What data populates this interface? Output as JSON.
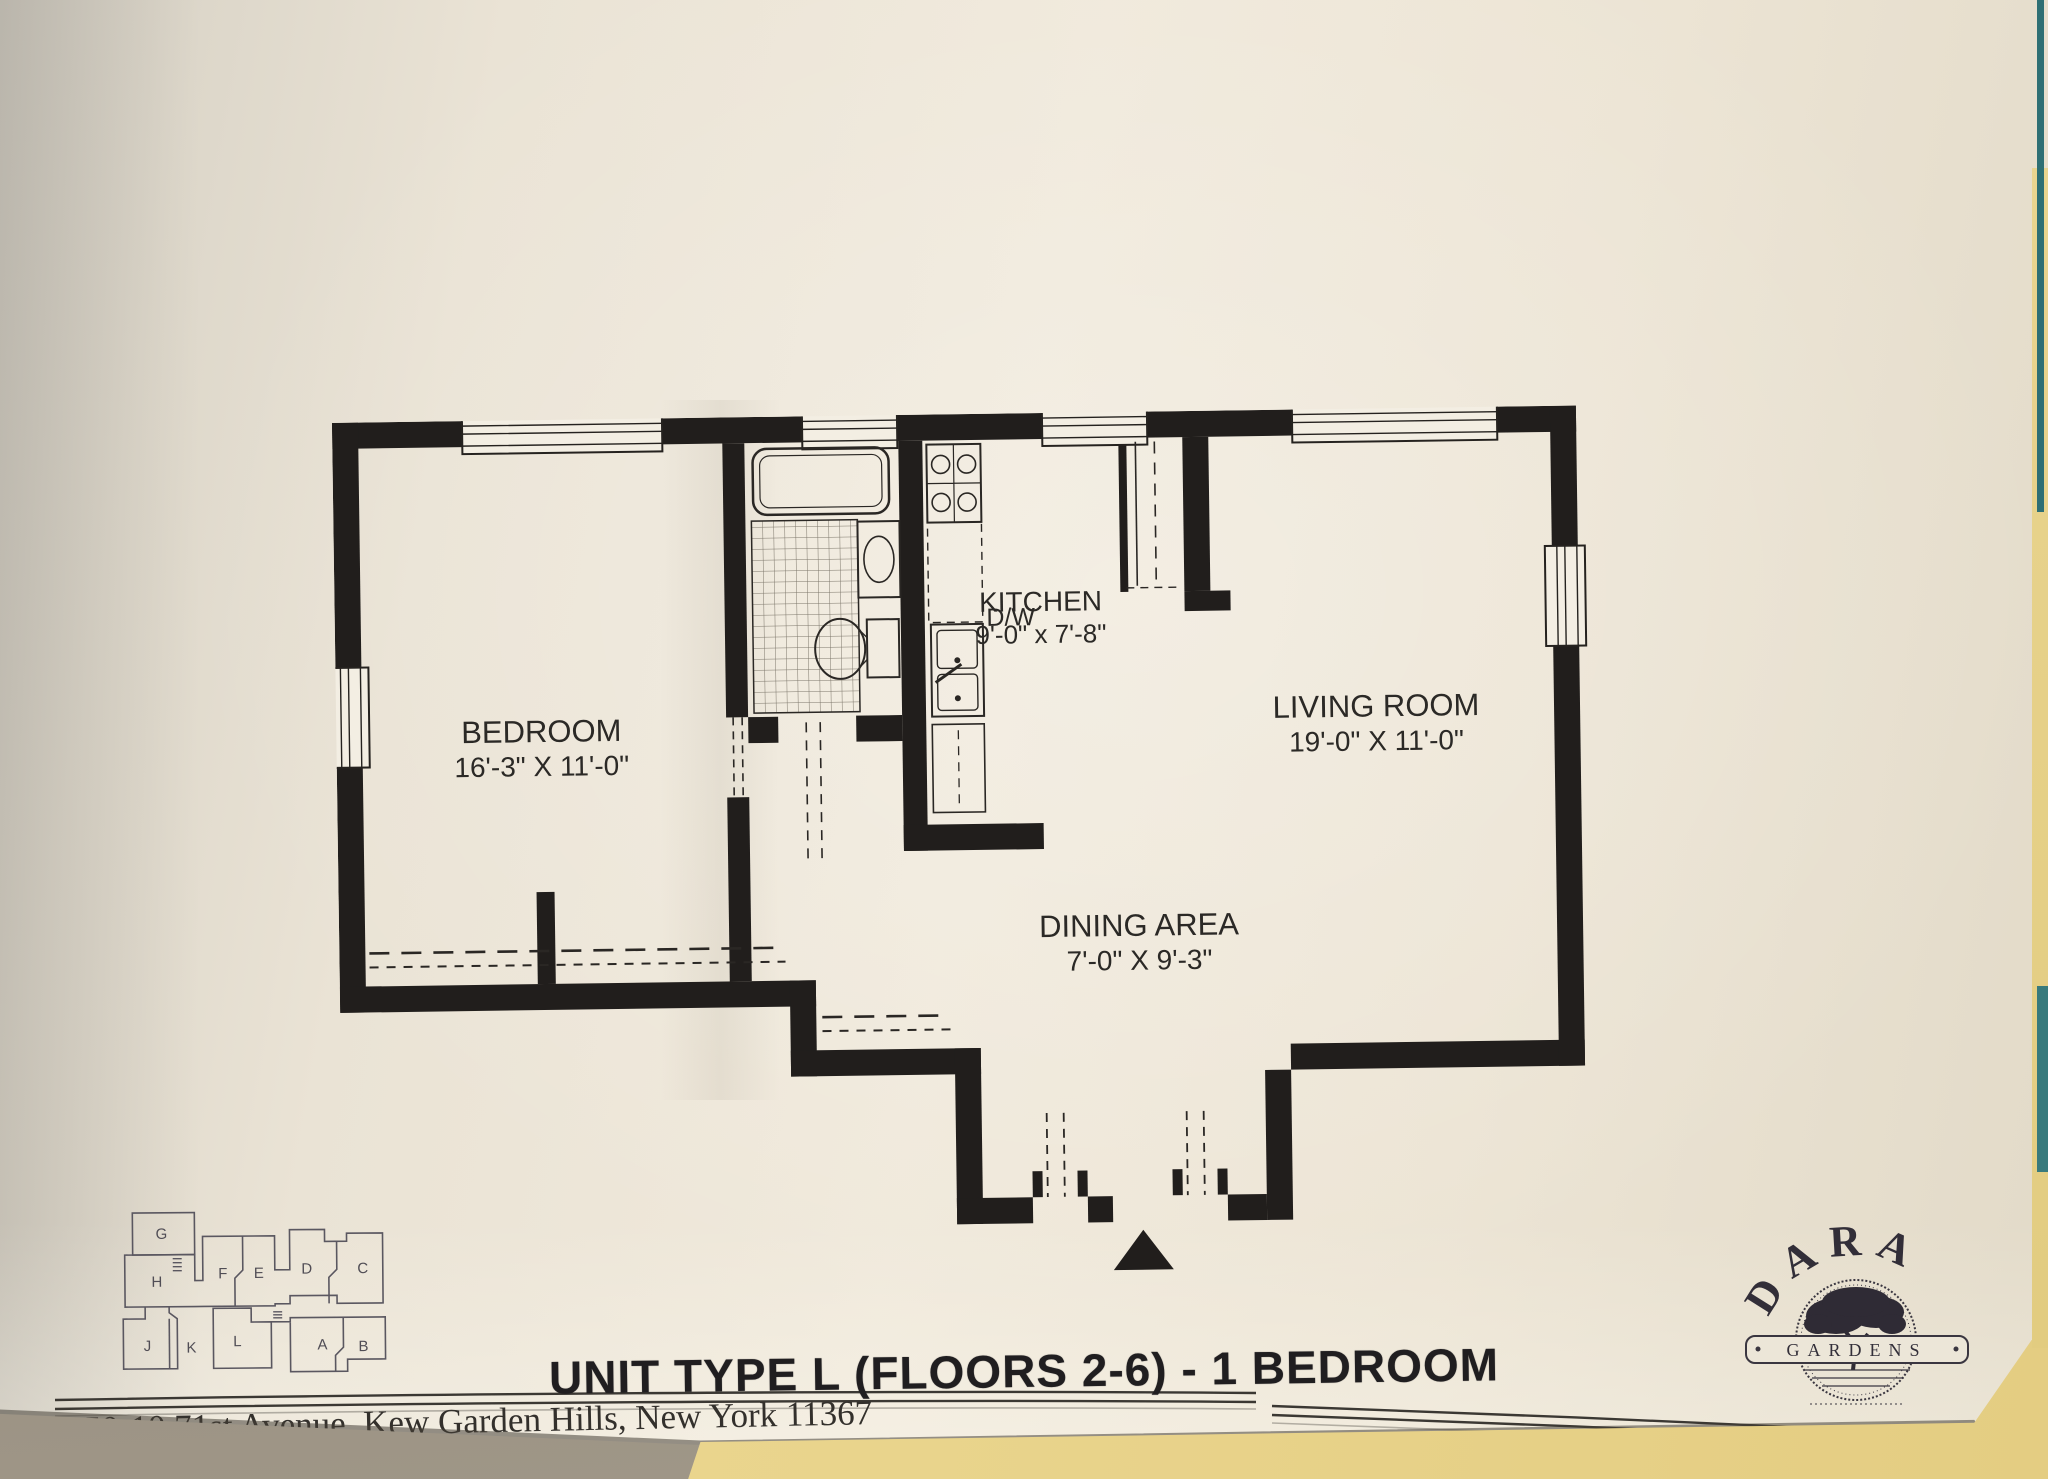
{
  "plan": {
    "rooms": [
      {
        "name": "BEDROOM",
        "dims": "16'-3\" X 11'-0\""
      },
      {
        "name": "KITCHEN",
        "dims": "9'-0\" x 7'-8\""
      },
      {
        "name": "LIVING ROOM",
        "dims": "19'-0\" X 11'-0\""
      },
      {
        "name": "DINING AREA",
        "dims": "7'-0\" X 9'-3\""
      }
    ],
    "labels": {
      "dishwasher": "D/W"
    }
  },
  "key_map": {
    "units_top": [
      "G",
      "H",
      "F",
      "E",
      "D",
      "C"
    ],
    "units_bottom": [
      "J",
      "K",
      "L",
      "A",
      "B"
    ]
  },
  "logo": {
    "brand": "DARA",
    "sub": "GARDENS"
  },
  "footer": {
    "title": "UNIT TYPE L (FLOORS 2-6) - 1 BEDROOM",
    "address": "150-10 71st Avenue, Kew Garden Hills, New York 11367",
    "phone": "Phone: 718.575.1000",
    "realty": "Dara Realty Associates"
  },
  "colors": {
    "ink": "#211e1c",
    "paper": "#efe8da",
    "yellow_paper": "#e9d48c",
    "teal_edge": "#2e6f74"
  }
}
